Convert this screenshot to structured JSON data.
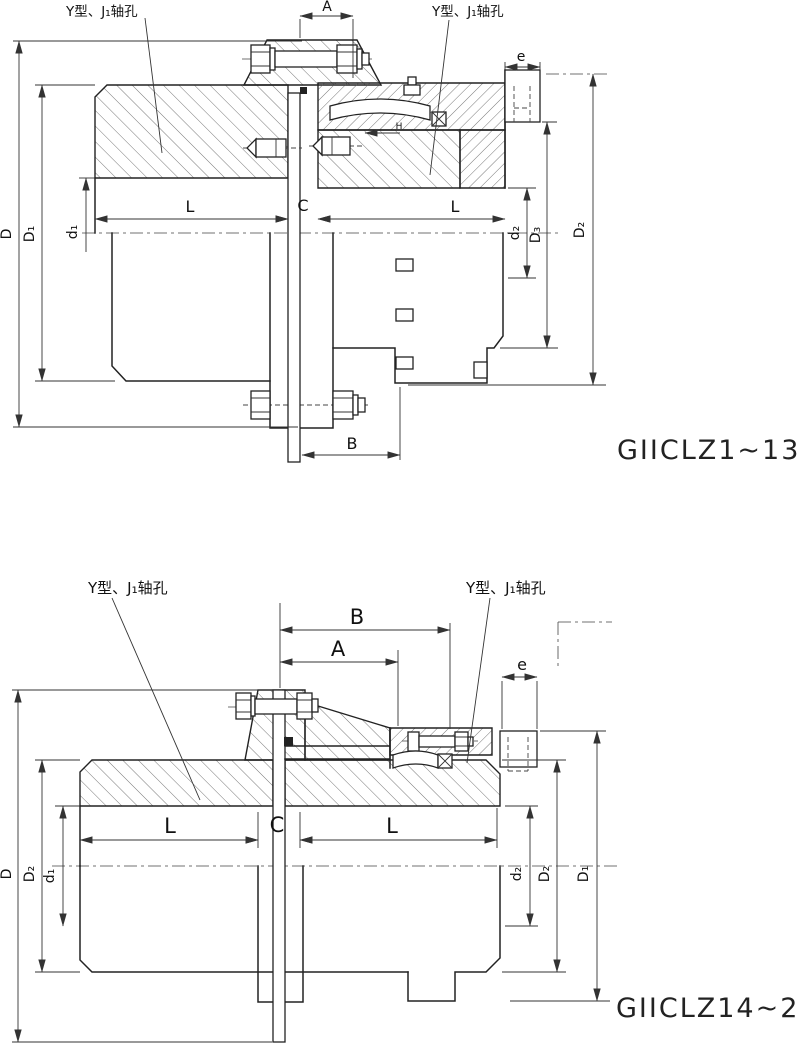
{
  "top": {
    "title": "GIICLZ1~13",
    "bore_label_left": "Y型、J₁轴孔",
    "bore_label_right": "Y型、J₁轴孔",
    "dims": {
      "A": "A",
      "B": "B",
      "C": "C",
      "e": "e",
      "H": "H",
      "L_left": "L",
      "L_right": "L",
      "D": "D",
      "D1": "D₁",
      "d1": "d₁",
      "d2": "d₂",
      "D3": "D₃",
      "D2": "D₂"
    }
  },
  "bottom": {
    "title": "GIICLZ14~21",
    "bore_label_left": "Y型、J₁轴孔",
    "bore_label_right": "Y型、J₁轴孔",
    "dims": {
      "A": "A",
      "B": "B",
      "C": "C",
      "e": "e",
      "L_left": "L",
      "L_right": "L",
      "D": "D",
      "D2_left": "D₂",
      "d1": "d₁",
      "d2": "d₂",
      "D2_right": "D₂",
      "D1": "D₁"
    }
  },
  "style": {
    "line_color": "#222222",
    "background": "#ffffff"
  }
}
